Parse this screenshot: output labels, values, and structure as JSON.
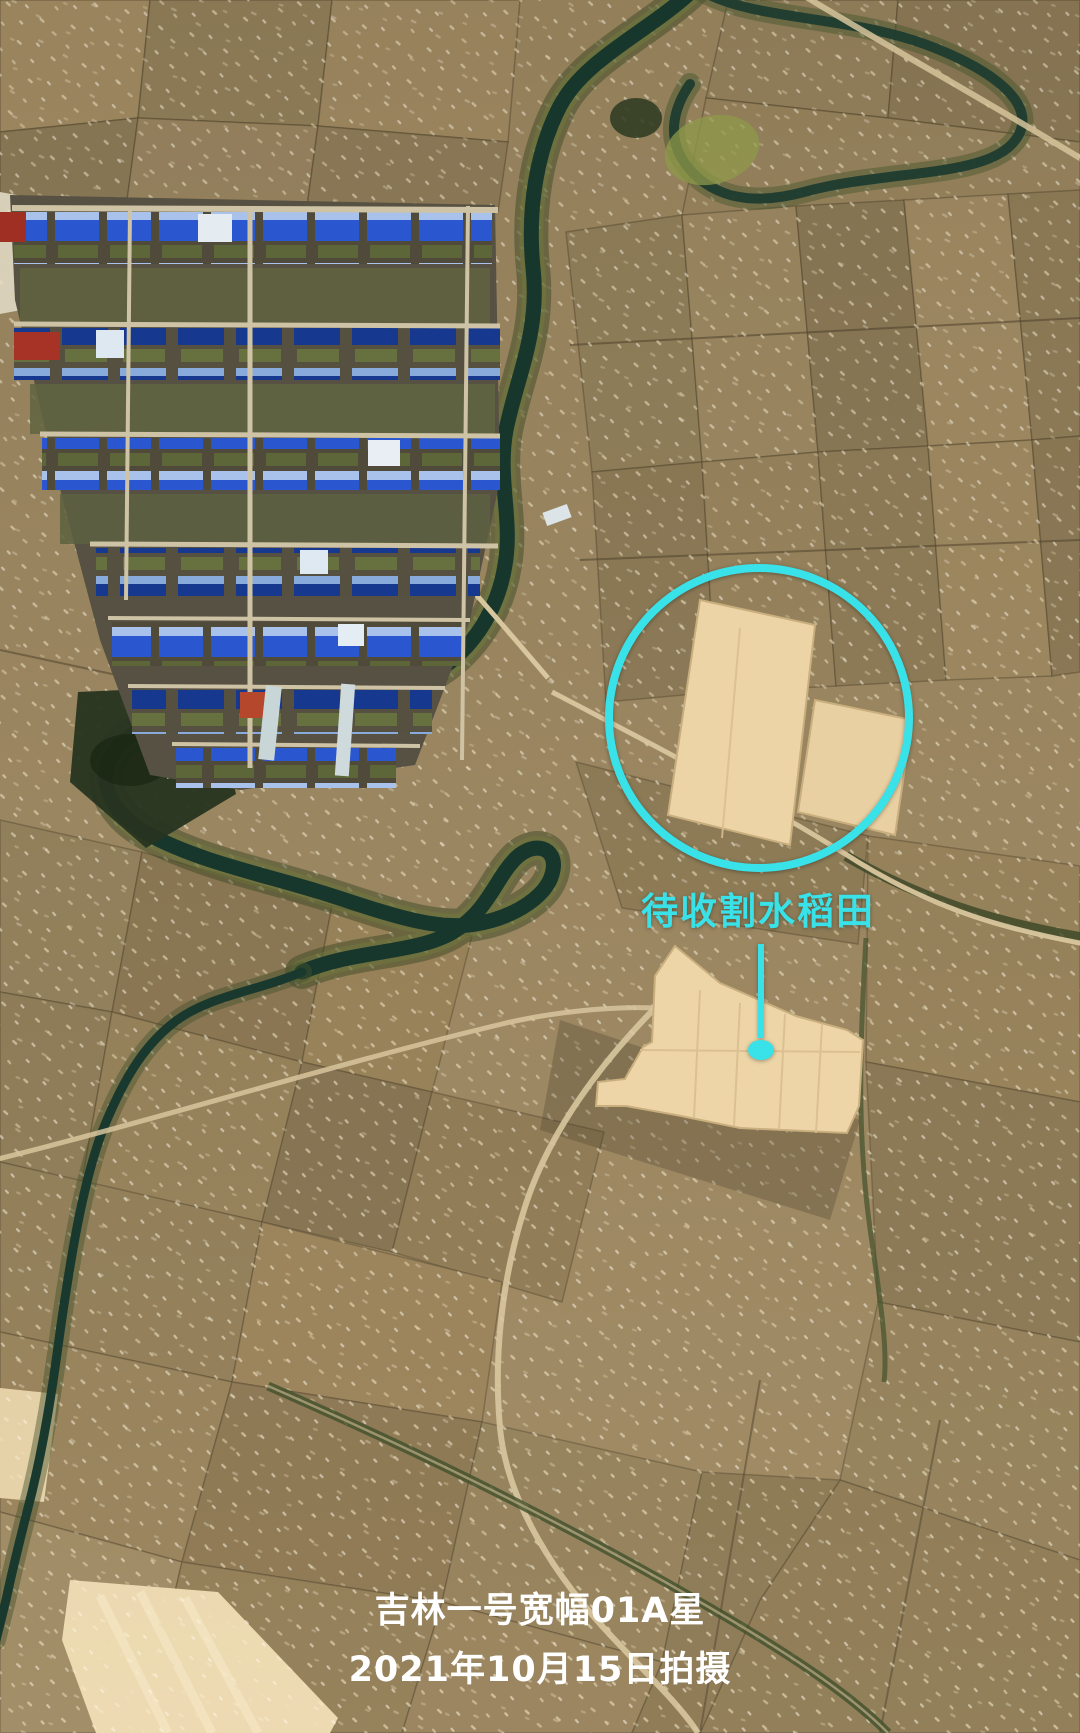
{
  "annotation": {
    "label": "待收割水稻田",
    "color": "#38E2E8"
  },
  "caption": {
    "line1": "吉林一号宽幅01A星",
    "line2": "2021年10月15日拍摄",
    "color": "#FFFFFF"
  },
  "palette": {
    "field_base": "#9C8760",
    "paddy_cream": "#ECD4A6",
    "river_water": "#17362C",
    "tree_green": "#3D4926",
    "roof_blue": "#2A57CF",
    "road_light": "#D8C69E"
  }
}
